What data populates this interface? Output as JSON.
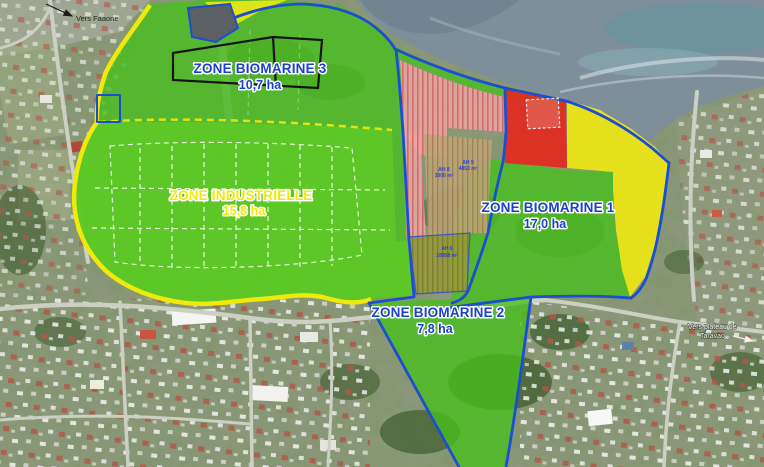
{
  "zones": {
    "biomarine3": {
      "name": "ZONE BIOMARINE 3",
      "area": "10,7 ha"
    },
    "industrielle": {
      "name": "ZONE INDUSTRIELLE",
      "area": "15,8 ha"
    },
    "biomarine1": {
      "name": "ZONE BIOMARINE 1",
      "area": "17,0 ha"
    },
    "biomarine2": {
      "name": "ZONE BIOMARINE 2",
      "area": "7,8 ha"
    }
  },
  "parcels": {
    "ah8": {
      "ref": "AH 8",
      "size": "3000 m²"
    },
    "ah9": {
      "ref": "AH 9",
      "size": "4853 m²"
    },
    "ah6": {
      "ref": "AH 6",
      "size": "18958 m²"
    }
  },
  "annotations": {
    "faaone": {
      "text": "Vers Faaone"
    },
    "taravao": {
      "line1": "Vers plateau de",
      "line2": "Taravao"
    }
  },
  "colors": {
    "zone_green": "#46c01c",
    "zi_green": "#5ecb25",
    "zone_yellow": "#f2ea10",
    "zone_red": "#e8231a",
    "border_blue": "#1d4ed2",
    "label_blue": "#1b41c8",
    "label_yellow": "#f2ea00"
  }
}
